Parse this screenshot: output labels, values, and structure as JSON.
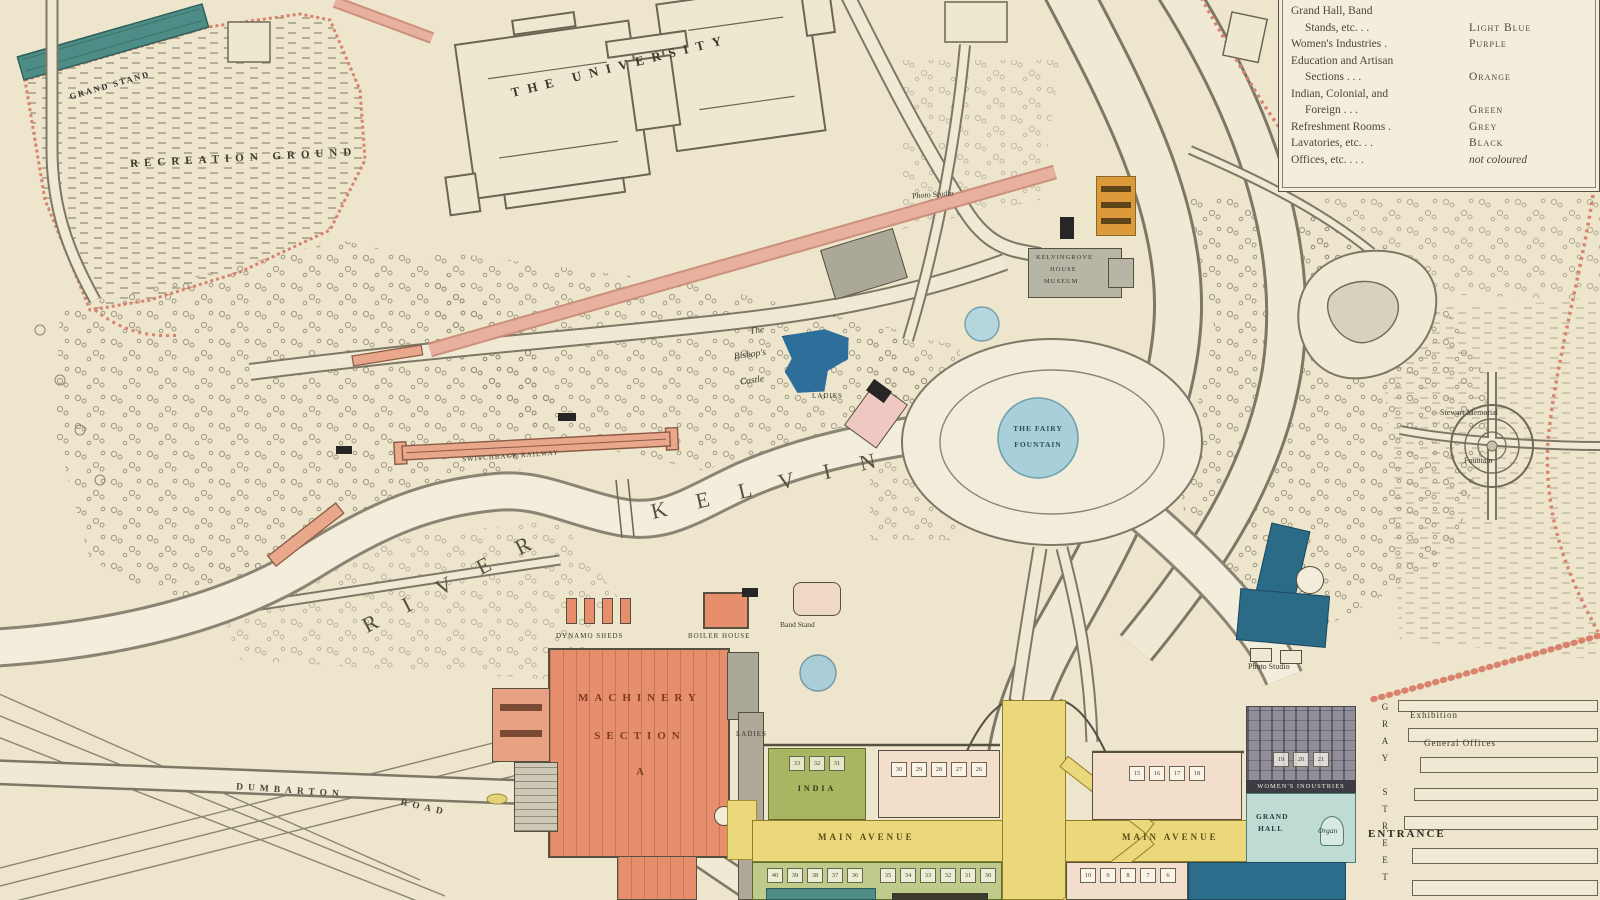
{
  "legend": {
    "rows": [
      {
        "l": "Grand Hall,  Band",
        "v": "",
        "indent": false,
        "italic": false
      },
      {
        "l": "Stands, etc.   .        .",
        "v": "Light Blue",
        "indent": true,
        "italic": false
      },
      {
        "l": "Women's Industries    .",
        "v": "Purple",
        "indent": false,
        "italic": false
      },
      {
        "l": "Education and Artisan",
        "v": "",
        "indent": false,
        "italic": false
      },
      {
        "l": "Sections    .      .      .",
        "v": "Orange",
        "indent": true,
        "italic": false
      },
      {
        "l": "Indian,  Colonial,  and",
        "v": "",
        "indent": false,
        "italic": false
      },
      {
        "l": "Foreign    .      .      .",
        "v": "Green",
        "indent": true,
        "italic": false
      },
      {
        "l": "Refreshment Rooms    .",
        "v": "Grey",
        "indent": false,
        "italic": false
      },
      {
        "l": "Lavatories, etc.   .        .",
        "v": "Black",
        "indent": false,
        "italic": false
      },
      {
        "l": "Offices, etc. .      .      .",
        "v": "not coloured",
        "indent": false,
        "italic": true
      }
    ]
  },
  "labels": {
    "university": "THE UNIVERSITY",
    "grand_stand": "GRAND STAND",
    "recreation_ground": "RECREATION GROUND",
    "river_word1": "RIVER",
    "river_word2": "KELVIN",
    "fairy_line1": "THE FAIRY",
    "fairy_line2": "FOUNTAIN",
    "bishops_line1": "The",
    "bishops_line2": "Bishop's",
    "bishops_line3": "Castle",
    "machinery_line1": "MACHINERY",
    "machinery_line2": "SECTION",
    "machinery_line3": "A",
    "main_avenue": "MAIN AVENUE",
    "dumbarton_word1": "DUMBARTON",
    "dumbarton_word2": "ROAD",
    "india": "INDIA",
    "grand_hall_line1": "GRAND",
    "grand_hall_line2": "HALL",
    "organ": "Organ",
    "womens_industries": "WOMEN'S INDUSTRIES",
    "entrance": "ENTRANCE",
    "gray_street": "GRAY STREET",
    "exhibition": "Exhibition",
    "general_offices": "General Offices",
    "stewart_line1": "Stewart Memorial",
    "stewart_line2": "Fountain",
    "photo_studio": "Photo Studio",
    "band_stand": "Band Stand",
    "dynamo_sheds": "DYNAMO SHEDS",
    "boiler_house": "BOILER HOUSE",
    "ladies": "LADIES",
    "kelvingrove_line1": "KELVINGROVE",
    "kelvingrove_line2": "HOUSE",
    "kelvingrove_line3": "MUSEUM",
    "switchback": "SWITCHBACK RAILWAY"
  },
  "stands": {
    "green_upper": [
      "33",
      "32",
      "31"
    ],
    "west_upper": [
      "30",
      "29",
      "28",
      "27",
      "26"
    ],
    "east_upper": [
      "15",
      "16",
      "17",
      "18"
    ],
    "hall_upper": [
      "19",
      "20",
      "21"
    ],
    "west_lower": [
      "40",
      "39",
      "38",
      "37",
      "36"
    ],
    "mid_lower": [
      "35",
      "34",
      "33",
      "32",
      "31",
      "30"
    ],
    "east_lower": [
      "10",
      "9",
      "8",
      "7",
      "6"
    ]
  },
  "colors": {
    "parchment": "#EDE5CC",
    "salmon": "#E78E6D",
    "yellow": "#EBD87B",
    "green": "#A9B661",
    "teal_stand": "#4E8D87",
    "hall_teal": "#BEDBD4",
    "dark_blue": "#2C6D8C",
    "bishop_blue": "#2E6E9B",
    "fountain_blue": "#A8CFDA",
    "orange": "#DD9A3A",
    "grey_building": "#ABA89A",
    "boundary_pink": "#D9826E",
    "line": "#6F6A58"
  }
}
